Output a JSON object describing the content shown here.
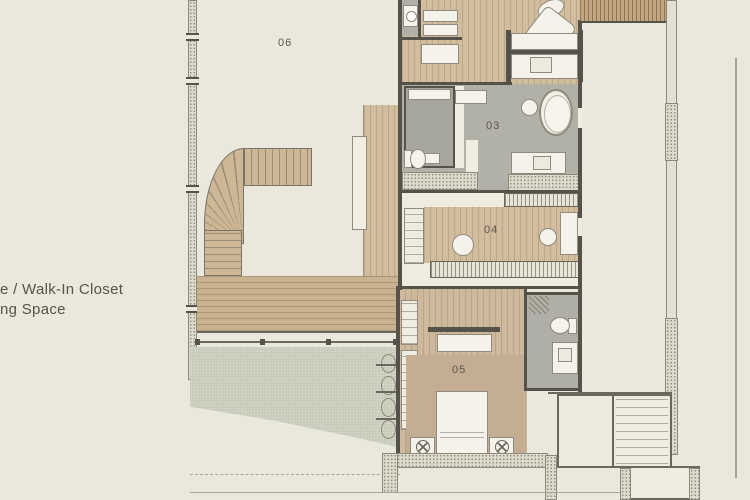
{
  "plan": {
    "title": "residence-floor-plan",
    "legend": {
      "line1": "e / Walk-In Closet",
      "line2": "ng Space"
    },
    "rooms": {
      "r06": "06",
      "r03": "03",
      "r04": "04",
      "r05": "05"
    },
    "colors": {
      "background": "#eae7dd",
      "wood_floor": "#d2bd9f",
      "deck_wood": "#c9b28f",
      "stair_wood": "#cdb795",
      "tile_gray": "#b2b1a7",
      "shower_gray": "#a7a69c",
      "green_area": "#c9ccbb",
      "rug": "#c3ad93",
      "wall_dark": "#55524a",
      "stipple_wall": "#ddd9cb",
      "fixture_white": "#f4f2ea",
      "label_text": "#5a564c"
    }
  }
}
